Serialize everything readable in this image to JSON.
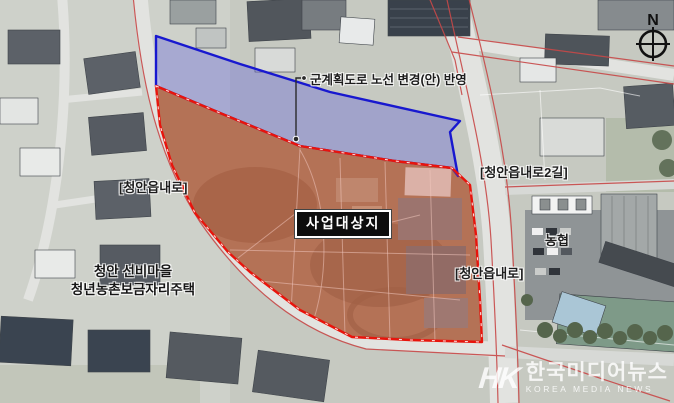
{
  "map": {
    "annotations": {
      "note": "군계획도로 노선 변경(안) 반영",
      "road_left": "[청안읍내로]",
      "road_right_upper": "[청안읍내로2길]",
      "road_right_lower": "[청안읍내로]",
      "site": "사업대상지",
      "village_line1": "청안 선비마을",
      "village_line2": "청년농촌보금자리주택",
      "nonghyup": "농협"
    },
    "compass_label": "N",
    "colors": {
      "site_boundary": "#e8140c",
      "site_fill": "rgba(205,70,45,0.32)",
      "change_boundary": "#1818cf",
      "change_fill": "rgba(75,75,225,0.30)",
      "road_line": "#c84848"
    }
  },
  "watermark": {
    "logo": "HK",
    "name_ko": "한국미디어뉴스",
    "name_en": "KOREA MEDIA NEWS"
  }
}
